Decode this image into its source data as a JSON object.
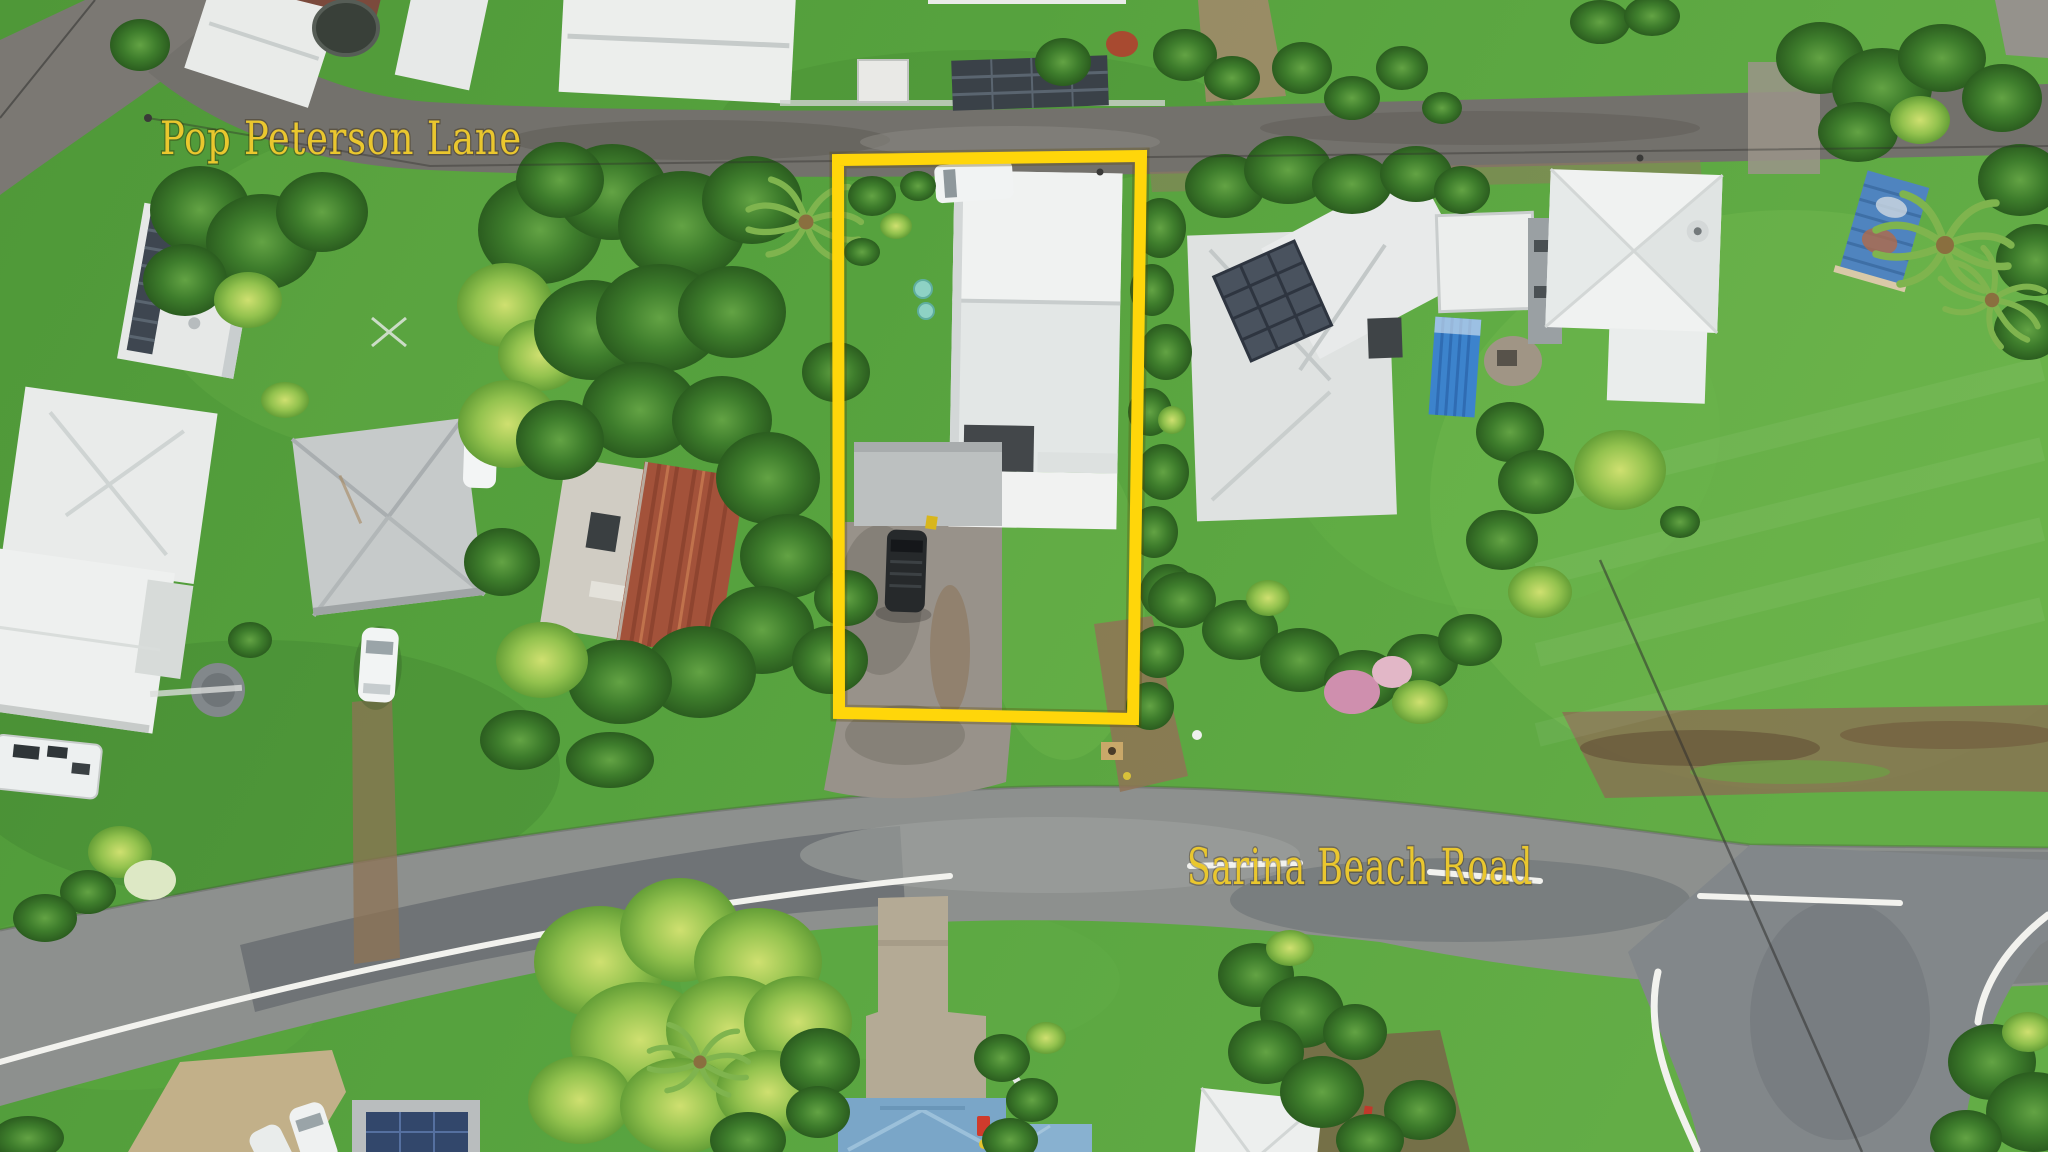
{
  "scene": {
    "type": "aerial-drone-photo",
    "description": "Bird's-eye view of a residential neighbourhood; a deep house lot is outlined in yellow between Pop Peterson Lane (top) and Sarina Beach Road (bottom).",
    "street_labels": [
      {
        "id": "pop-peterson-lane",
        "text": "Pop Peterson Lane"
      },
      {
        "id": "sarina-beach-road",
        "text": "Sarina Beach Road"
      }
    ],
    "label_color": "#EAC72E",
    "highlight": {
      "shape": "rectangle",
      "color": "#FFD60A",
      "purpose": "property-boundary"
    },
    "palette": {
      "grass": "#549F3C",
      "grass_light": "#6CB74B",
      "asphalt": "#8B8E8C",
      "asphalt_dark": "#5F646A",
      "roof_white": "#ECEEED",
      "roof_gray": "#C4C8C9",
      "roof_rust": "#A3523A",
      "roof_blue": "#7AA6C8",
      "container_blue": "#3C83CC",
      "shed_blue": "#4F84BF",
      "gravel": "#98928A",
      "concrete": "#B4AA95",
      "dirt": "#8F7356"
    }
  }
}
